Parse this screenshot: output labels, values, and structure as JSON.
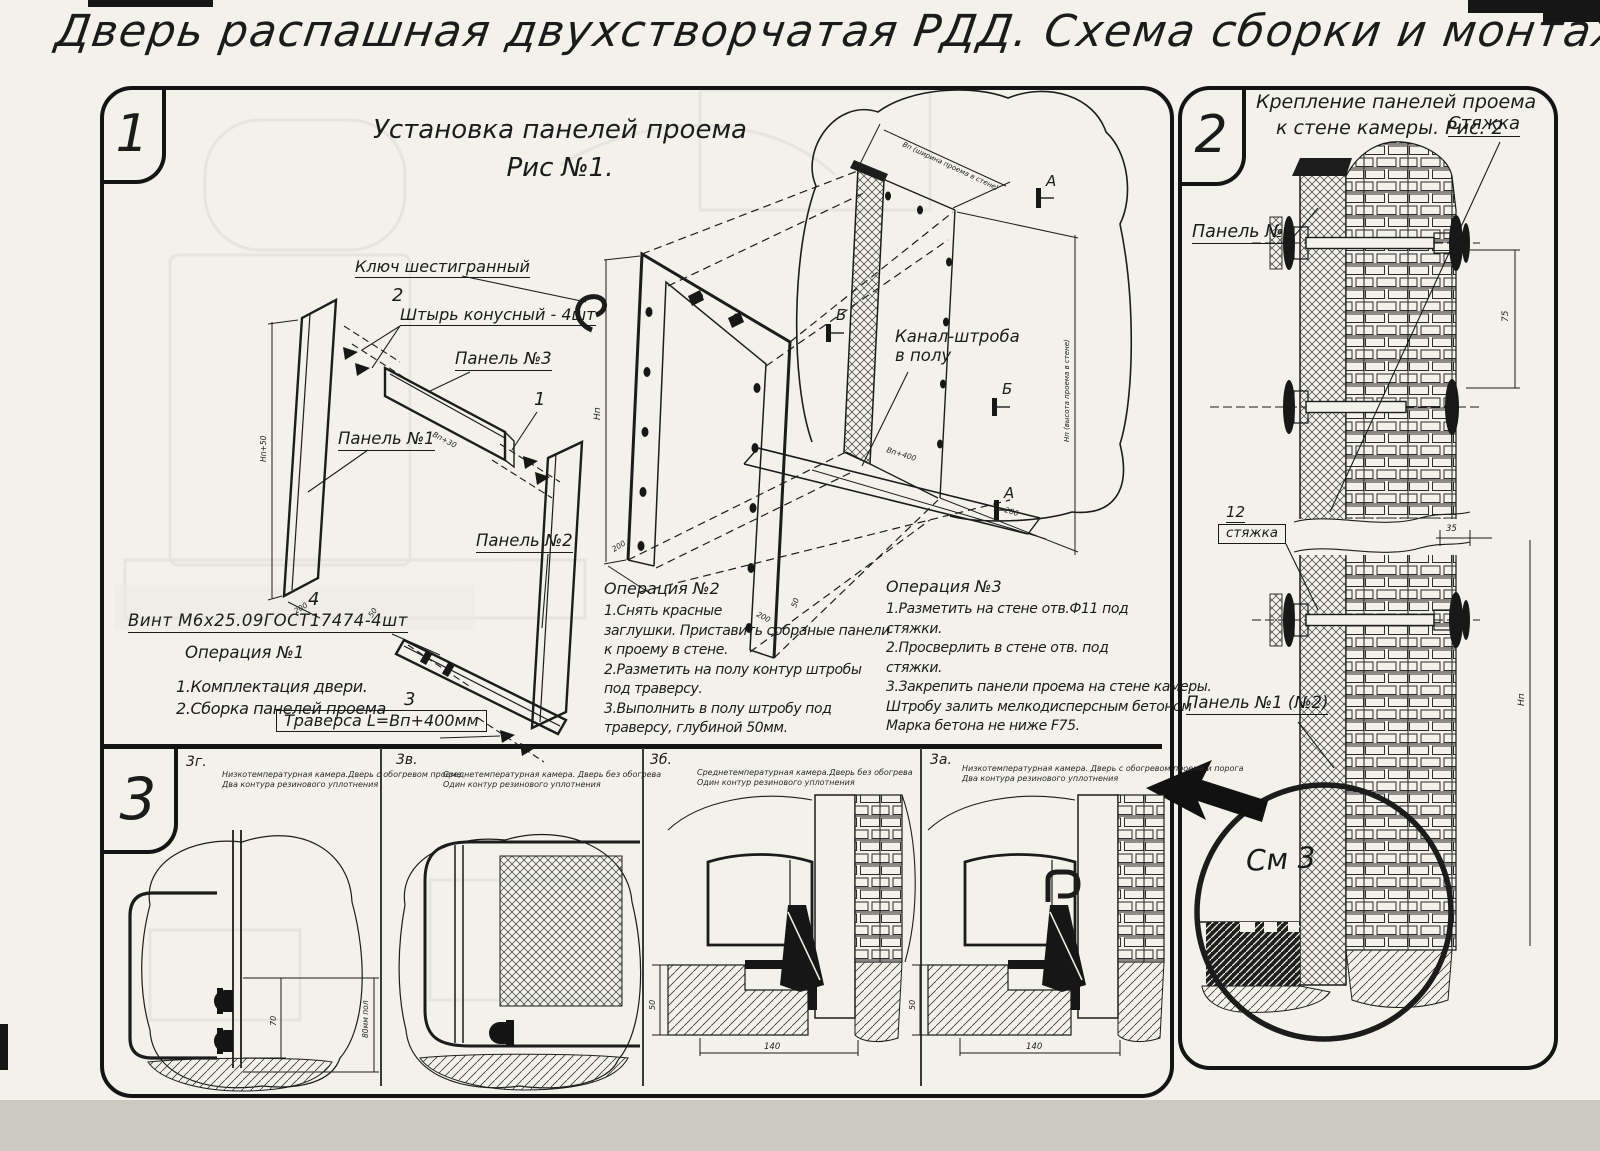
{
  "page": {
    "title": "Дверь распашная двухстворчатая РДД.  Схема сборки и монтажа №2"
  },
  "s1": {
    "badge": "1",
    "fig_title1": "Установка панелей проема",
    "fig_title2": "Рис №1.",
    "labels": {
      "key": "Ключ шестигранный",
      "pos2": "2",
      "pin": "Штырь конусный - 4шт",
      "panel3": "Панель №3",
      "pos1": "1",
      "panel1": "Панель №1",
      "panel2": "Панель №2",
      "pos4": "4",
      "screw": "Винт М6х25.09ГОСТ17474-4шт",
      "pos3": "3",
      "traverse": "Траверса  L=Bп+400мм",
      "channel1": "Канал-штроба",
      "channel2": "в полу",
      "mA": "А",
      "mB": "Б"
    },
    "dims": {
      "np50": "Нп+50",
      "d200": "200",
      "d50": "50",
      "vp30": "Вп+30",
      "np": "Нп",
      "vp400": "Вп+400",
      "wallw": "Вп (ширина проема в стене)",
      "wallh": "Нп (высота проема в стене)"
    },
    "op1": {
      "title": "Операция №1",
      "lines": [
        "1.Комплектация двери.",
        "2.Сборка панелей проема"
      ]
    },
    "op2": {
      "title": "Операция №2",
      "lines": [
        "1.Снять красные",
        "заглушки. Приставить собраные панели",
        "к проему в стене.",
        "2.Разметить на полу контур штробы",
        "под траверсу.",
        "3.Выполнить в полу штробу под",
        "траверсу, глубиной 50мм."
      ]
    },
    "op3": {
      "title": "Операция №3",
      "lines": [
        "1.Разметить на стене отв.Ф11 под",
        "стяжки.",
        "2.Просверлить в стене отв.  под",
        "стяжки.",
        "3.Закрепить панели проема на стене камеры.",
        "Штробу залить мелкодисперсным бетоном",
        "Марка бетона не ниже  F75."
      ]
    }
  },
  "s2": {
    "badge": "2",
    "title1": "Крепление панелей проема",
    "title2": "к стене камеры. Рис. 2",
    "labels": {
      "tie": "Стяжка",
      "panel3": "Панель №3",
      "pos12": "12",
      "tie2": "стяжка",
      "panel12": "Панель №1 (№2)",
      "see": "См 3"
    },
    "dims": {
      "d75": "75",
      "d35": "35",
      "dnp": "Нп"
    }
  },
  "s3": {
    "badge": "3",
    "views": [
      {
        "id": "3г.",
        "c1": "Низкотемпературная камера.Дверь с обогревом проема",
        "c2": "Два контура резинового уплотнения"
      },
      {
        "id": "3в.",
        "c1": "Среднетемпературная камера. Дверь без обогрева",
        "c2": "Один контур резинового уплотнения"
      },
      {
        "id": "3б.",
        "c1": "Среднетемпературная камера.Дверь без обогрева",
        "c2": "Один контур резинового уплотнения"
      },
      {
        "id": "3а.",
        "c1": "Низкотемпературная камера. Дверь с обогревом проема и порога",
        "c2": "Два контура резинового уплотнения"
      }
    ],
    "dims": {
      "d70": "70",
      "d80": "80мм пол",
      "d50": "50",
      "d140": "140"
    }
  }
}
